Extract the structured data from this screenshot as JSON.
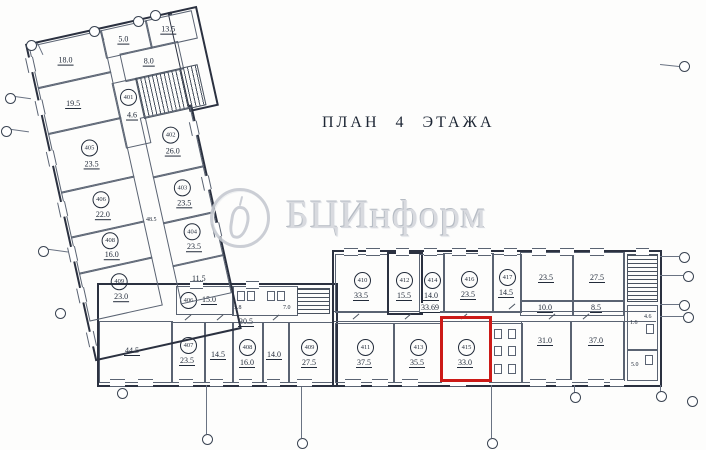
{
  "title": "ПЛАН 4 ЭТАЖА",
  "watermark": {
    "text": "БЦИнформ",
    "logo": "candle-in-circle"
  },
  "colors": {
    "wall": "#2b3140",
    "partition": "#5a6372",
    "highlight": "#cc1a17",
    "watermark": "#c6cad1"
  },
  "rooms": {
    "r18": {
      "area": "18.0"
    },
    "r5": {
      "area": "5.0"
    },
    "r13h": {
      "area": "13.5"
    },
    "r8": {
      "area": "8.0"
    },
    "r19": {
      "area": "19.5"
    },
    "r401": {
      "num": "401",
      "area": "4.6"
    },
    "r402": {
      "num": "402",
      "area": "26.0"
    },
    "r403": {
      "num": "403",
      "area": "23.5"
    },
    "r404": {
      "num": "404",
      "area": "23.5"
    },
    "w1": {
      "num": "405",
      "area": "23.5"
    },
    "w2": {
      "num": "406",
      "area": "22.0"
    },
    "w3": {
      "num": "408",
      "area": "16.0"
    },
    "w4": {
      "num": "409",
      "area": "23.0"
    },
    "r11": {
      "area": "11.5"
    },
    "dim48": {
      "area": "48.5"
    },
    "r44": {
      "area": "44.5"
    },
    "r406c": {
      "num": "406",
      "area": "15.0"
    },
    "wcA": {
      "area": "5.8"
    },
    "wcB": {
      "area": "7.0"
    },
    "corr30": {
      "area": "30.5"
    },
    "r407": {
      "num": "407",
      "area": "23.5"
    },
    "r14a": {
      "area": "14.5"
    },
    "r408": {
      "num": "408",
      "area": "16.0"
    },
    "r14b": {
      "area": "14.0"
    },
    "r409": {
      "num": "409",
      "area": "27.5"
    },
    "r410": {
      "num": "410",
      "area": "33.5"
    },
    "r412": {
      "num": "412",
      "area": "15.5"
    },
    "r414": {
      "num": "414",
      "area": "14.0"
    },
    "r416": {
      "num": "416",
      "area": "23.5"
    },
    "r417": {
      "num": "417",
      "area": "14.5"
    },
    "r23e": {
      "area": "23.5"
    },
    "r27e": {
      "area": "27.5"
    },
    "corr33": {
      "area": "33.69"
    },
    "c10": {
      "area": "10.0"
    },
    "c85": {
      "area": "8.5"
    },
    "r411": {
      "num": "411",
      "area": "37.5"
    },
    "r413": {
      "num": "413",
      "area": "35.5"
    },
    "r415": {
      "num": "415",
      "area": "33.0"
    },
    "r31": {
      "area": "31.0"
    },
    "r37": {
      "area": "37.0"
    },
    "s16": {
      "area": "1.6"
    },
    "s46": {
      "area": "4.6"
    },
    "s50": {
      "area": "5.0"
    }
  }
}
